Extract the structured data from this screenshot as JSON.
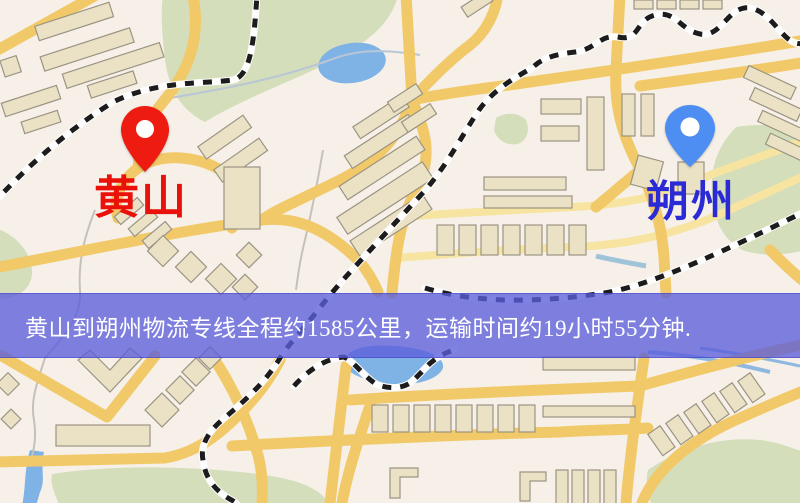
{
  "map": {
    "origin_marker": {
      "label": "黄山",
      "pin_color": "#ee1b10",
      "label_color": "#e91109"
    },
    "destination_marker": {
      "label": "朔州",
      "pin_color": "#4e8df2",
      "label_color": "#2b2bd5"
    },
    "banner": {
      "text": "黄山到朔州物流专线全程约1585公里，运输时间约19小时55分钟.",
      "background": "rgba(91,94,219,0.78)",
      "text_color": "#ffffff"
    },
    "palette": {
      "land": "#f6f0e9",
      "road_main": "#f1c968",
      "road_minor": "#f7e4a0",
      "water": "#7fb3e6",
      "park": "#d4debb",
      "railway": "#1c1c1c",
      "building": "#ebe2c6"
    }
  }
}
